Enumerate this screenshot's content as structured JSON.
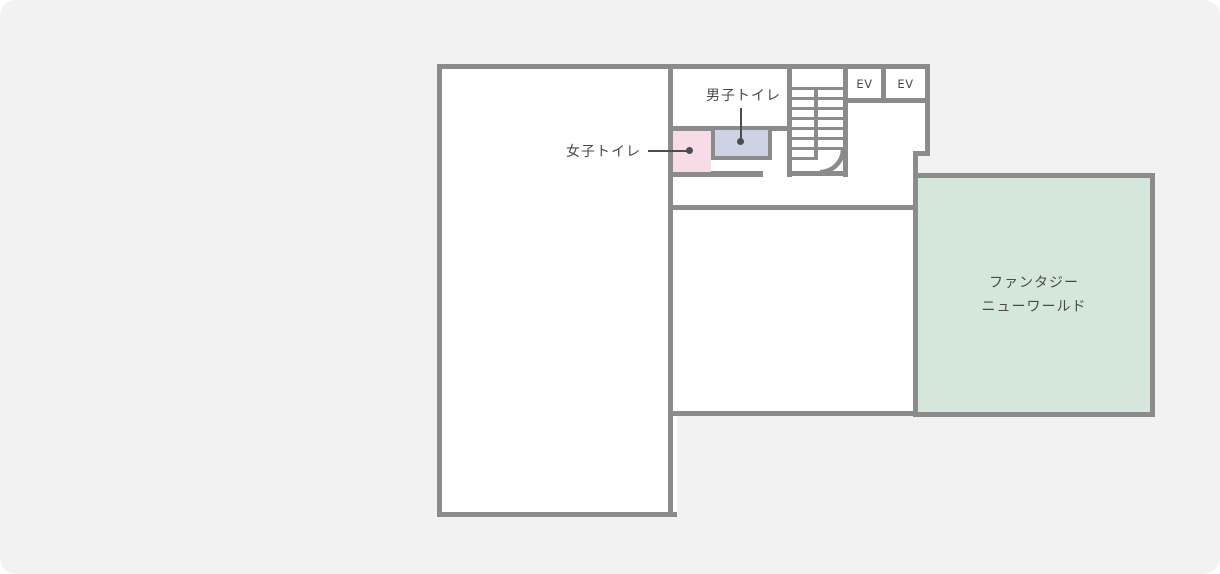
{
  "floorplan": {
    "title": "facility floor map",
    "rooms": {
      "womens_toilet": {
        "label": "女子トイレ"
      },
      "mens_toilet": {
        "label": "男子トイレ"
      },
      "elevators": [
        {
          "label": "EV"
        },
        {
          "label": "EV"
        }
      ],
      "fantasy_new_world": {
        "label_line1": "ファンタジー",
        "label_line2": "ニューワールド"
      }
    },
    "colors": {
      "background": "#f2f2f3",
      "wall": "#8b8b8b",
      "room_fill": "#ffffff",
      "womens_toilet_fill": "#f5dce7",
      "mens_toilet_fill": "#cdd3e5",
      "fantasy_room_fill": "#d5e7db",
      "label_text": "#4a4a4a",
      "marker": "#4d4d4d"
    }
  }
}
